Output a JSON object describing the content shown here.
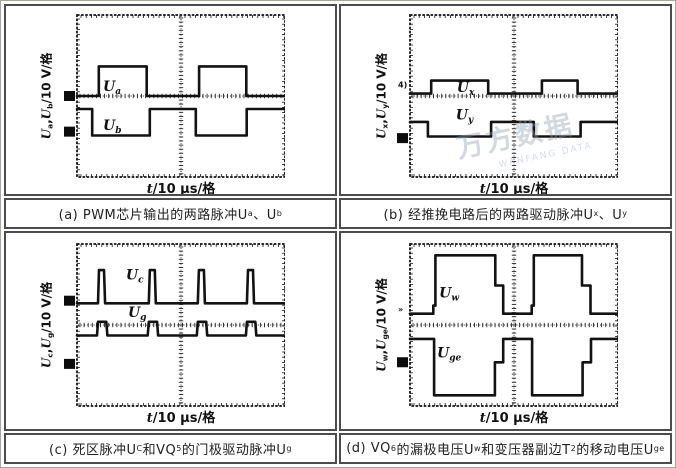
{
  "watermark": {
    "cn": "万方数据",
    "en": "WANFANG DATA"
  },
  "chart_data": {
    "type": "oscillogram-grid",
    "x_axis_per_div": "10 μs/格",
    "y_axis_per_div": "10 V/格",
    "xlabel": [
      {
        "t": "t",
        "i": true
      },
      {
        "t": "/10 μs/格"
      }
    ],
    "panels": [
      {
        "id": "a",
        "caption": [
          {
            "t": "(a) PWM芯片输出的两路脉冲U"
          },
          {
            "t": "a",
            "sub": true
          },
          {
            "t": "、U"
          },
          {
            "t": "b",
            "sub": true
          }
        ],
        "ylabel": [
          {
            "t": "U",
            "i": true
          },
          {
            "t": "a",
            "sub": true
          },
          {
            "t": ","
          },
          {
            "t": "U",
            "i": true
          },
          {
            "t": "b",
            "sub": true
          },
          {
            "t": "/10 V/格"
          }
        ],
        "traces": [
          {
            "name": "Ua",
            "label_main": "U",
            "label_sub": "a",
            "label_pos": [
              0.125,
              0.47
            ],
            "points": [
              [
                0,
                0.5
              ],
              [
                0.105,
                0.5
              ],
              [
                0.105,
                0.317
              ],
              [
                0.335,
                0.317
              ],
              [
                0.335,
                0.5
              ],
              [
                0.587,
                0.5
              ],
              [
                0.587,
                0.317
              ],
              [
                0.814,
                0.317
              ],
              [
                0.814,
                0.5
              ],
              [
                1,
                0.5
              ]
            ]
          },
          {
            "name": "Ub",
            "label_main": "U",
            "label_sub": "b",
            "label_pos": [
              0.125,
              0.71
            ],
            "points": [
              [
                0,
                0.58
              ],
              [
                0.073,
                0.58
              ],
              [
                0.073,
                0.744
              ],
              [
                0.35,
                0.744
              ],
              [
                0.35,
                0.58
              ],
              [
                0.571,
                0.58
              ],
              [
                0.571,
                0.744
              ],
              [
                0.816,
                0.744
              ],
              [
                0.816,
                0.58
              ],
              [
                1,
                0.58
              ]
            ]
          }
        ],
        "markers": [
          {
            "type": "square",
            "y": 0.5
          },
          {
            "type": "square",
            "y": 0.72
          }
        ]
      },
      {
        "id": "b",
        "caption": [
          {
            "t": "(b) 经推挽电路后的两路驱动脉冲U"
          },
          {
            "t": "x",
            "sub": true
          },
          {
            "t": "、U"
          },
          {
            "t": "y",
            "sub": true
          }
        ],
        "ylabel": [
          {
            "t": "U",
            "i": true
          },
          {
            "t": "x",
            "sub": true
          },
          {
            "t": ","
          },
          {
            "t": "U",
            "i": true
          },
          {
            "t": "y",
            "sub": true
          },
          {
            "t": "/10 V/格"
          }
        ],
        "traces": [
          {
            "name": "Ux",
            "label_main": "U",
            "label_sub": "x",
            "label_pos": [
              0.225,
              0.475
            ],
            "points": [
              [
                0,
                0.485
              ],
              [
                0.102,
                0.485
              ],
              [
                0.102,
                0.405
              ],
              [
                0.376,
                0.405
              ],
              [
                0.376,
                0.485
              ],
              [
                0.634,
                0.485
              ],
              [
                0.634,
                0.405
              ],
              [
                0.806,
                0.405
              ],
              [
                0.806,
                0.485
              ],
              [
                1,
                0.485
              ]
            ]
          },
          {
            "name": "Uy",
            "label_main": "U",
            "label_sub": "y",
            "label_pos": [
              0.22,
              0.645
            ],
            "points": [
              [
                0,
                0.66
              ],
              [
                0.086,
                0.66
              ],
              [
                0.086,
                0.75
              ],
              [
                0.39,
                0.75
              ],
              [
                0.39,
                0.66
              ],
              [
                0.595,
                0.66
              ],
              [
                0.595,
                0.75
              ],
              [
                0.82,
                0.75
              ],
              [
                0.82,
                0.66
              ],
              [
                1,
                0.66
              ]
            ]
          }
        ],
        "markers": [
          {
            "type": "text",
            "text": "4)",
            "y": 0.43
          },
          {
            "type": "square",
            "y": 0.76
          }
        ]
      },
      {
        "id": "c",
        "caption": [
          {
            "t": "(c) 死区脉冲U"
          },
          {
            "t": "C",
            "sub": true
          },
          {
            "t": "和VQ"
          },
          {
            "t": "5",
            "sub": true
          },
          {
            "t": "的门极驱动脉冲U"
          },
          {
            "t": "g",
            "sub": true
          }
        ],
        "ylabel": [
          {
            "t": "U",
            "i": true
          },
          {
            "t": "c",
            "sub": true
          },
          {
            "t": ","
          },
          {
            "t": "U",
            "i": true
          },
          {
            "t": "g",
            "sub": true
          },
          {
            "t": "/10 V/格"
          }
        ],
        "traces": [
          {
            "name": "Uc",
            "label_main": "U",
            "label_sub": "c",
            "label_pos": [
              0.235,
              0.22
            ],
            "points": [
              [
                0,
                0.366
              ],
              [
                0.101,
                0.366
              ],
              [
                0.106,
                0.161
              ],
              [
                0.13,
                0.161
              ],
              [
                0.135,
                0.366
              ],
              [
                0.345,
                0.366
              ],
              [
                0.35,
                0.161
              ],
              [
                0.374,
                0.161
              ],
              [
                0.379,
                0.366
              ],
              [
                0.581,
                0.366
              ],
              [
                0.586,
                0.161
              ],
              [
                0.61,
                0.161
              ],
              [
                0.615,
                0.366
              ],
              [
                0.817,
                0.366
              ],
              [
                0.822,
                0.161
              ],
              [
                0.846,
                0.161
              ],
              [
                0.851,
                0.366
              ],
              [
                1,
                0.366
              ]
            ]
          },
          {
            "name": "Ug",
            "label_main": "U",
            "label_sub": "g",
            "label_pos": [
              0.245,
              0.45
            ],
            "points": [
              [
                0,
                0.565
              ],
              [
                0.096,
                0.565
              ],
              [
                0.101,
                0.48
              ],
              [
                0.141,
                0.48
              ],
              [
                0.146,
                0.565
              ],
              [
                0.34,
                0.565
              ],
              [
                0.345,
                0.48
              ],
              [
                0.385,
                0.48
              ],
              [
                0.39,
                0.565
              ],
              [
                0.576,
                0.565
              ],
              [
                0.581,
                0.48
              ],
              [
                0.621,
                0.48
              ],
              [
                0.626,
                0.565
              ],
              [
                0.812,
                0.565
              ],
              [
                0.817,
                0.48
              ],
              [
                0.857,
                0.48
              ],
              [
                0.862,
                0.565
              ],
              [
                1,
                0.565
              ]
            ]
          }
        ],
        "markers": [
          {
            "type": "square",
            "y": 0.35
          },
          {
            "type": "square",
            "y": 0.74
          }
        ]
      },
      {
        "id": "d",
        "caption": [
          {
            "t": "(d) VQ"
          },
          {
            "t": "6",
            "sub": true
          },
          {
            "t": "的漏极电压U"
          },
          {
            "t": "w",
            "sub": true
          },
          {
            "t": "和变压器副边T"
          },
          {
            "t": "2",
            "sub": true
          },
          {
            "t": "的移动电压U"
          },
          {
            "t": "ge",
            "sub": true
          }
        ],
        "ylabel": [
          {
            "t": "U",
            "i": true
          },
          {
            "t": "w",
            "sub": true
          },
          {
            "t": ","
          },
          {
            "t": "U",
            "i": true
          },
          {
            "t": "ge",
            "sub": true
          },
          {
            "t": "/10 V/格"
          }
        ],
        "traces": [
          {
            "name": "Uw",
            "label_main": "U",
            "label_sub": "w",
            "label_pos": [
              0.14,
              0.33
            ],
            "points": [
              [
                0,
                0.43
              ],
              [
                0.112,
                0.43
              ],
              [
                0.112,
                0.38
              ],
              [
                0.122,
                0.38
              ],
              [
                0.122,
                0.07
              ],
              [
                0.41,
                0.07
              ],
              [
                0.41,
                0.256
              ],
              [
                0.448,
                0.256
              ],
              [
                0.448,
                0.43
              ],
              [
                0.585,
                0.43
              ],
              [
                0.585,
                0.38
              ],
              [
                0.595,
                0.38
              ],
              [
                0.595,
                0.07
              ],
              [
                0.827,
                0.07
              ],
              [
                0.827,
                0.256
              ],
              [
                0.868,
                0.256
              ],
              [
                0.868,
                0.43
              ],
              [
                1,
                0.43
              ]
            ]
          },
          {
            "name": "Uge",
            "label_main": "U",
            "label_sub": "ge",
            "label_pos": [
              0.13,
              0.7
            ],
            "points": [
              [
                0,
                0.586
              ],
              [
                0.116,
                0.586
              ],
              [
                0.116,
                0.934
              ],
              [
                0.408,
                0.934
              ],
              [
                0.408,
                0.73
              ],
              [
                0.448,
                0.73
              ],
              [
                0.448,
                0.586
              ],
              [
                0.587,
                0.586
              ],
              [
                0.587,
                0.934
              ],
              [
                0.83,
                0.934
              ],
              [
                0.83,
                0.73
              ],
              [
                0.87,
                0.73
              ],
              [
                0.87,
                0.586
              ],
              [
                1,
                0.586
              ]
            ]
          }
        ],
        "markers": [
          {
            "type": "text",
            "text": "»",
            "y": 0.4
          },
          {
            "type": "square",
            "y": 0.73
          }
        ]
      }
    ]
  }
}
